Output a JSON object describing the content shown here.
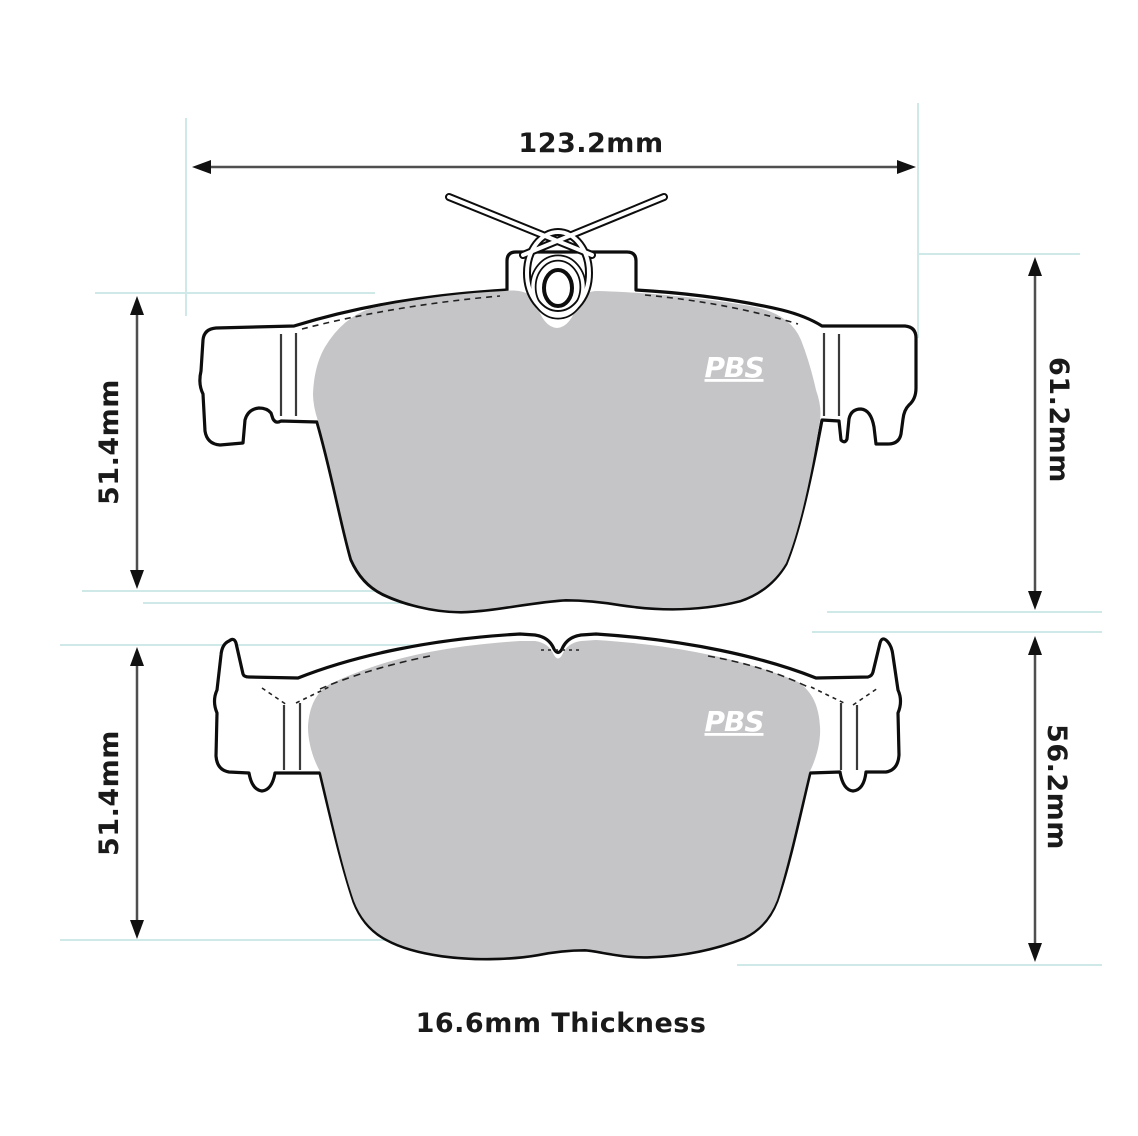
{
  "diagram": {
    "caption": "16.6mm Thickness",
    "brand": {
      "logo_text": "PBS"
    },
    "dimensions": {
      "overall_width": "123.2mm",
      "top_pad_height_left": "51.4mm",
      "top_pad_height_right": "61.2mm",
      "bottom_pad_height_left": "51.4mm",
      "bottom_pad_height_right": "56.2mm"
    },
    "colors": {
      "background": "#ffffff",
      "outline": "#0d0d0d",
      "friction_material": "#c5c5c7",
      "dimension_line": "#4f4f4f",
      "arrowhead": "#111111",
      "extension_line": "#cfe9e9",
      "logo_text": "#ffffff",
      "label_text": "#1a1a1a"
    }
  }
}
